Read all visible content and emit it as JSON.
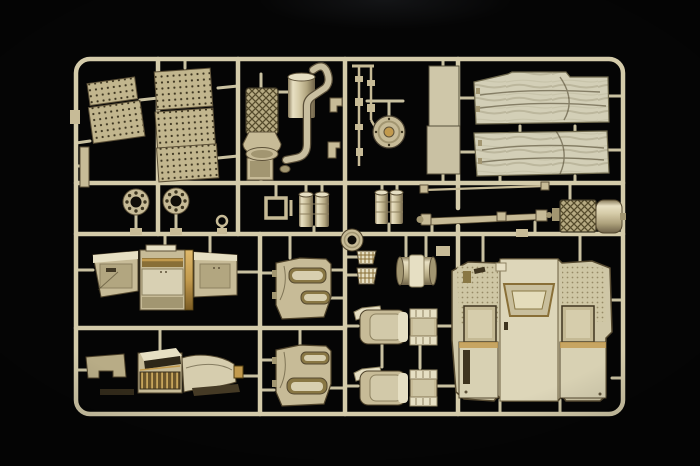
{
  "scene": {
    "description": "Photograph of a desert-tan injection-molded model kit sprue on a black background, containing truck cab and chassis detail parts",
    "background": "black studio backdrop",
    "frame_shape": "rounded rectangular runner frame with internal runner grid"
  },
  "palette": {
    "bg": "#050505",
    "plastic": "#c7bb95",
    "plastic_bright": "#e6dfc2",
    "plastic_dim": "#a3966f",
    "plastic_dark": "#5e5238",
    "runner": "#d4cba9",
    "accent_gold": "#c49a4a",
    "accent_dark_gold": "#8a6f35",
    "canvas": "#d3cfb6",
    "recess": "#2e2717"
  },
  "parts": [
    {
      "name": "perforated-grille-panel-small",
      "qty": 1
    },
    {
      "name": "perforated-grille-panel-large",
      "qty": 1
    },
    {
      "name": "bolted-ring-flange",
      "qty": 2
    },
    {
      "name": "mesh-air-cleaner-with-bell",
      "qty": 1
    },
    {
      "name": "muffler-with-s-exhaust-pipe",
      "qty": 1
    },
    {
      "name": "mirror-arm-rods",
      "qty": 2
    },
    {
      "name": "spare-wheel-hub-disc",
      "qty": 1
    },
    {
      "name": "tall-flat-panel",
      "qty": 1
    },
    {
      "name": "canvas-tilt-cover-panel",
      "qty": 2
    },
    {
      "name": "fuel-drum-pair",
      "qty": 2
    },
    {
      "name": "open-frame-bracket",
      "qty": 1
    },
    {
      "name": "thin-tie-rod",
      "qty": 1
    },
    {
      "name": "drive-shaft",
      "qty": 1
    },
    {
      "name": "exhaust-muffler-with-mesh-heat-shield",
      "qty": 1
    },
    {
      "name": "dashboard-assembly",
      "qty": 1
    },
    {
      "name": "engine-cover-console-assembly",
      "qty": 1
    },
    {
      "name": "door-interior-panel",
      "qty": 2
    },
    {
      "name": "round-hub-cap",
      "qty": 1
    },
    {
      "name": "treadplate-pedal",
      "qty": 2
    },
    {
      "name": "ribbed-roller-drum",
      "qty": 1
    },
    {
      "name": "seat-base",
      "qty": 2
    },
    {
      "name": "seat-backrest",
      "qty": 2
    },
    {
      "name": "cab-floor-rear-wall-panel",
      "qty": 1
    },
    {
      "name": "small-gate-tabs-and-clips",
      "qty": 6
    }
  ]
}
